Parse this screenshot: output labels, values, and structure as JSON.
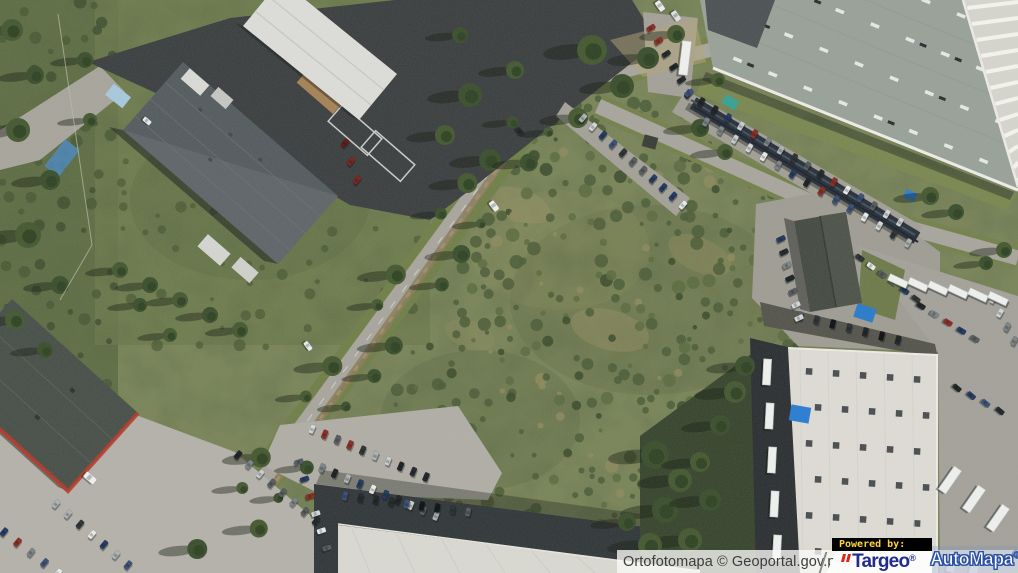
{
  "window": {
    "width_px": 1018,
    "height_px": 573
  },
  "map": {
    "view_type": "Ortofotomapa (aerial orthophoto)",
    "attribution_text": "Ortofotomapa © Geoportal.gov.pl",
    "logo": {
      "powered_by": "Powered by:",
      "targeo_text": "Targeo",
      "targeo_registered": "®",
      "automapa_text": "AutoMapa",
      "automapa_registered": "®"
    },
    "colors": {
      "attribution_background": "#f5f5f2",
      "attribution_text": "#3c3c3c",
      "powered_by_background": "#000000",
      "powered_by_text": "#ffd23f",
      "targeo_blue": "#232c8e",
      "targeo_red": "#e02418",
      "automapa_text": "#ffffff",
      "automapa_outline": "#2d52a4"
    },
    "terrain_palette": {
      "field_green": "#7a855a",
      "forest_green": "#46563a",
      "road_gray": "#a8a69d",
      "asphalt_dark": "#3d4142",
      "dark_roof": "#575e61",
      "light_roof": "#dcdbd4",
      "green_gray_roof": "#99a299",
      "red_accent": "#b23b2b",
      "solar_panel": "#2a323c"
    }
  }
}
